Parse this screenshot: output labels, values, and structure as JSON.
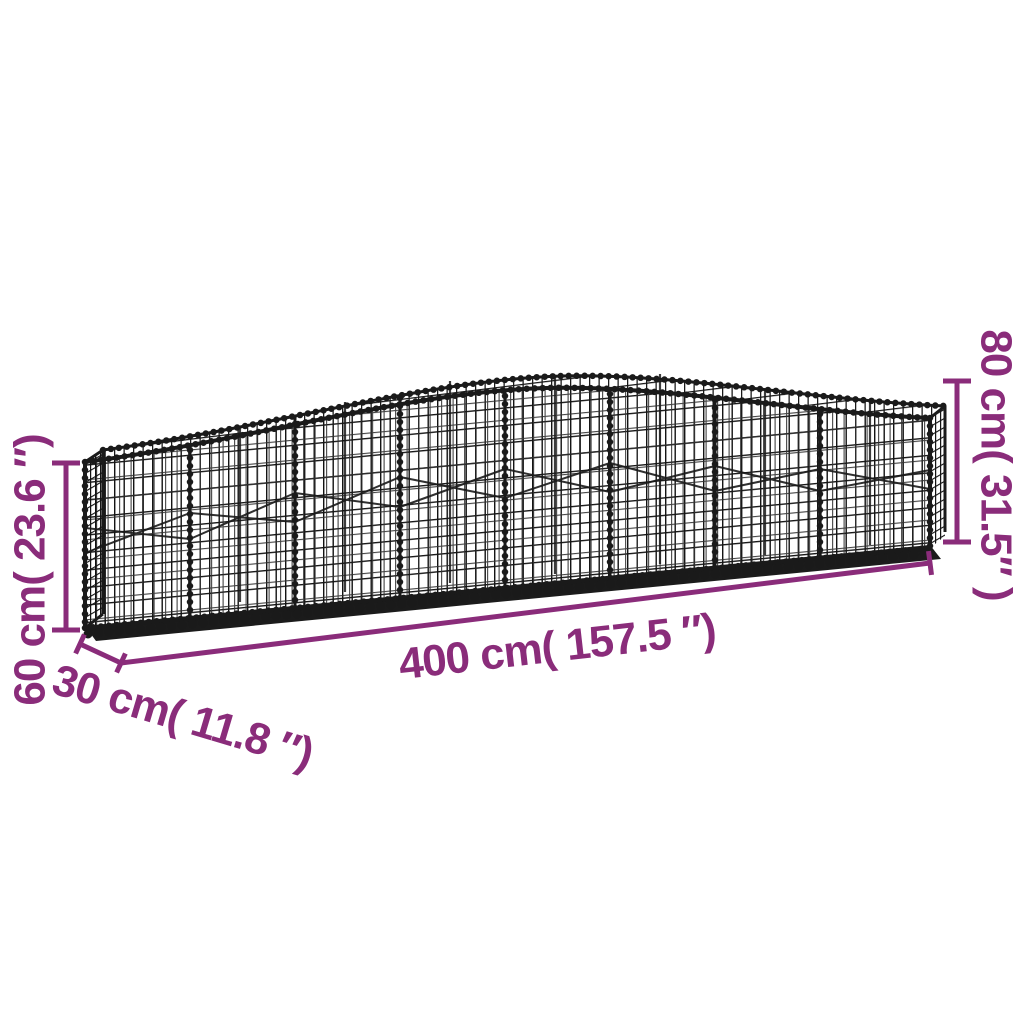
{
  "page": {
    "background": "#ffffff",
    "illustration": "arched-gabion-wire-mesh-basket"
  },
  "colors": {
    "accent": "#8A2C7A",
    "wire": "#1A1A1A"
  },
  "dimensions": {
    "length": {
      "label": "400 cm( 157.5 ″)",
      "cm": 400,
      "inches": 157.5
    },
    "depth": {
      "label": "30 cm( 11.8 ″)",
      "cm": 30,
      "inches": 11.8
    },
    "end_height": {
      "label": "60 cm( 23.6 ″)",
      "cm": 60,
      "inches": 23.6
    },
    "peak_height": {
      "label": "80 cm( 31.5″ )",
      "cm": 80,
      "inches": 31.5
    }
  }
}
